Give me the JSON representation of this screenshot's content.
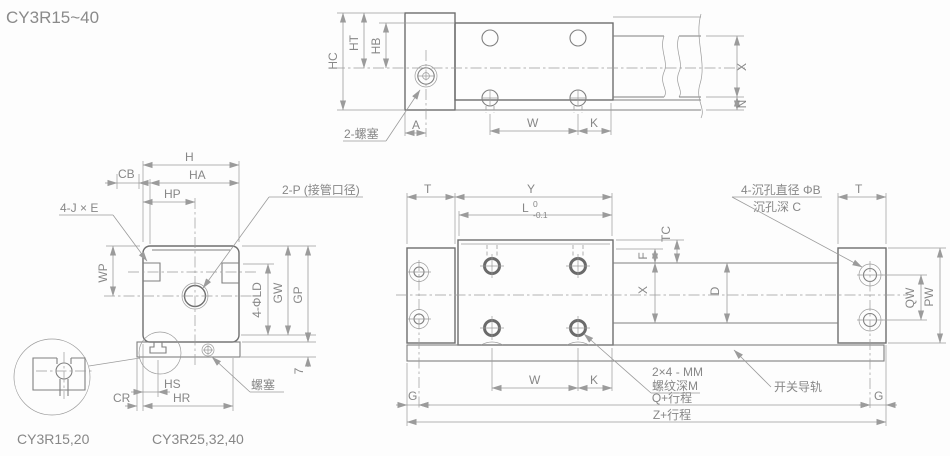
{
  "title": "CY3R15~40",
  "colors": {
    "outline": "#6e6e6e",
    "dim_line": "#9b9b9b",
    "text": "#878787"
  },
  "side_view": {
    "plug_label": "2-螺塞",
    "dims": {
      "hc": "HC",
      "ht": "HT",
      "hb": "HB",
      "x": "X",
      "n": "N",
      "a": "A",
      "w": "W",
      "k": "K"
    }
  },
  "front_view": {
    "corner_screws_label": "4-J × E",
    "port_label": "2-P (接管口径)",
    "plug_label": "螺塞",
    "dims": {
      "h": "H",
      "ha": "HA",
      "hp": "HP",
      "cb": "CB",
      "wp": "WP",
      "ld": "4-ΦLD",
      "gw": "GW",
      "gp": "GP",
      "rail_height": "7",
      "hs": "HS",
      "hr": "HR",
      "cr": "CR"
    }
  },
  "plan_view": {
    "counterbore_label_line1": "4-沉孔直径 ΦB",
    "counterbore_label_line2": "沉孔深 C",
    "thread_label_line1": "2×4 - MM",
    "thread_label_line2": "螺纹深M",
    "rail_label": "开关导轨",
    "dims": {
      "t_left": "T",
      "y": "Y",
      "l": "L",
      "l_tol_top": "0",
      "l_tol_bottom": "-0.1",
      "t_right": "T",
      "tc": "TC",
      "f": "F",
      "x": "X",
      "d": "D",
      "qw": "QW",
      "pw": "PW",
      "w": "W",
      "k": "K",
      "g_left": "G",
      "g_right": "G",
      "q_stroke": "Q+行程",
      "z_stroke": "Z+行程"
    }
  },
  "details": {
    "model_small": "CY3R15,20",
    "model_large": "CY3R25,32,40"
  }
}
